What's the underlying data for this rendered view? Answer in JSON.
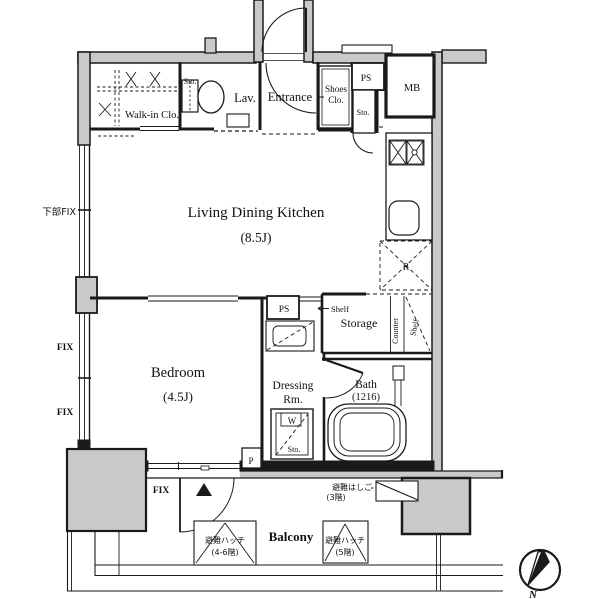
{
  "labels": {
    "walk_in_closet": "Walk-in Clo.",
    "sto_wic": "Sto.",
    "lav": "Lav.",
    "entrance": "Entrance",
    "shoes_clo_1": "Shoes",
    "shoes_clo_2": "Clo.",
    "ps_top": "PS",
    "sto_entrance": "Sto.",
    "mb": "MB",
    "ldk_name": "Living Dining Kitchen",
    "ldk_size": "(8.5J)",
    "kabu_fix": "下部FIX",
    "fix_upper": "FIX",
    "fix_lower": "FIX",
    "fix_balcony": "FIX",
    "bedroom_name": "Bedroom",
    "bedroom_size": "(4.5J)",
    "ps_mid": "PS",
    "shelf_top": "Shelf",
    "storage": "Storage",
    "counter": "Counter",
    "shelf_side": "Shelf",
    "dressing_1": "Dressing",
    "dressing_2": "Rm.",
    "bath_name": "Bath",
    "bath_size": "(1216)",
    "washer": "W",
    "sto_washer": "Sto.",
    "pipe": "P",
    "fridge": "R",
    "balcony": "Balcony",
    "ladder_1": "避難はしご",
    "ladder_2": "(3階)",
    "hatch_left_1": "避難ハッチ",
    "hatch_left_2": "(4-6階)",
    "hatch_right_1": "避難ハッチ",
    "hatch_right_2": "(5階)",
    "north": "N"
  },
  "colors": {
    "line": "#1a1a1a",
    "wall_fill": "#c9c9c9"
  }
}
